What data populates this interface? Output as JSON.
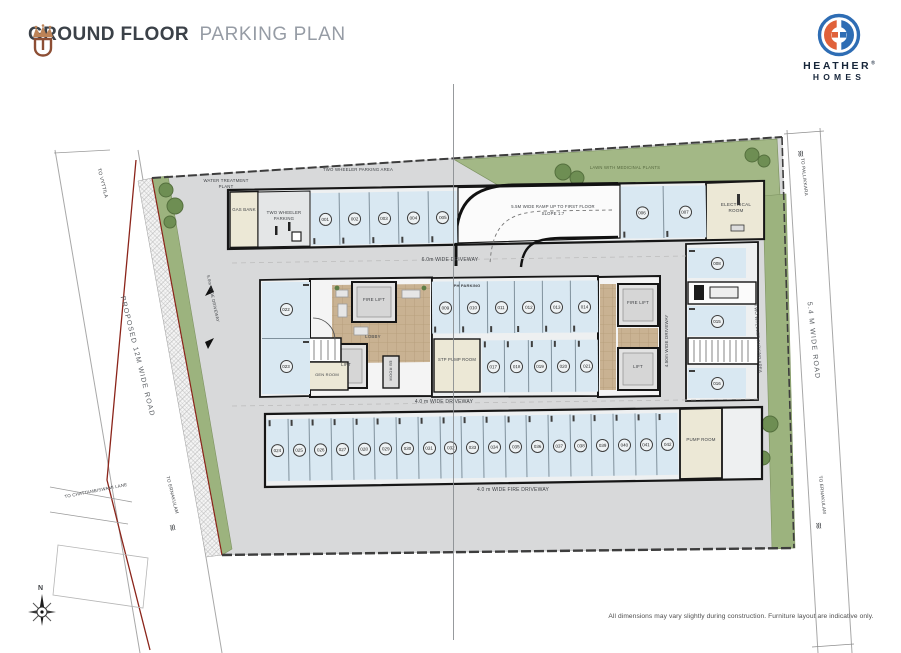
{
  "header": {
    "title_primary": "GROUND FLOOR",
    "title_secondary": "PARKING PLAN"
  },
  "brand": {
    "name_line1": "HEATHER",
    "name_line2": "HOMES",
    "registered_mark": "®"
  },
  "roads": {
    "left": {
      "name": "PROPOSED 12M WIDE ROAD",
      "top_destination": "TO VYTTILA",
      "lane_destination": "TO CHATTAMBISWAMI LANE",
      "bottom_destination": "TO ERNAKULAM"
    },
    "right": {
      "name": "5.4 M WIDE ROAD",
      "top_destination": "TO PALLIKKARA",
      "bottom_destination": "TO ERNAKULAM"
    }
  },
  "driveways": {
    "top": "6.0m WIDE DRIVEWAY",
    "middle": "4.0 m WIDE DRIVEWAY",
    "fire": "4.0 m WIDE FIRE DRIVEWAY",
    "cross": "4.50m WIDE DRIVEWAY",
    "entry": "5.0m WIDE DRIVEWAY"
  },
  "ramp": {
    "line1": "5.5M WIDE RAMP UP TO FIRST FLOOR",
    "line2": "SLOPE 1:7"
  },
  "rooms": {
    "electrical": "ELECTRICAL ROOM",
    "pump": "PUMP ROOM",
    "stp_pump": "STP PUMP ROOM",
    "gas_bank": "GAS BANK",
    "water_treatment": "WATER TREATMENT PLANT",
    "generator": "GEN ROOM",
    "eb": "EB ROOM",
    "lift": "LIFT",
    "fire_lift": "FIRE LIFT",
    "lobby": "LOBBY"
  },
  "labels": {
    "two_wheeler_parking": "TWO WHEELER PARKING",
    "two_wheeler_area": "TWO WHEELER PARKING AREA",
    "lawn": "LAWN WITH MEDICINAL PLANTS",
    "ph_parking": "PH PARKING",
    "road_break_symbol": "≋"
  },
  "stalls": {
    "top_row": [
      "001",
      "002",
      "003",
      "004",
      "005"
    ],
    "ramp_right": [
      "006",
      "007"
    ],
    "right_col_top": [
      "008"
    ],
    "mid_up": [
      "009",
      "010",
      "011",
      "012",
      "013",
      "014"
    ],
    "right_mid_upper": [
      "015"
    ],
    "right_mid_lower": [
      "016"
    ],
    "mid_down": [
      "017",
      "018",
      "019",
      "020",
      "021"
    ],
    "left_col": [
      "022",
      "023"
    ],
    "bottom_row": [
      "024",
      "025",
      "026",
      "027",
      "028",
      "029",
      "030",
      "031",
      "032",
      "033",
      "034",
      "035",
      "036",
      "037",
      "038",
      "039",
      "040",
      "041",
      "042"
    ]
  },
  "compass": {
    "north_label": "N"
  },
  "footer": {
    "disclaimer": "All dimensions may vary slightly during construction. Furniture layout are indicative only."
  },
  "colors": {
    "accent_copper": "#b97f54",
    "logo_blue": "#2e6db4",
    "logo_orange": "#e0613a",
    "stall_blue": "#d9e8f2",
    "lawn_green": "#a3b886",
    "boundary_red": "#8b241a"
  }
}
